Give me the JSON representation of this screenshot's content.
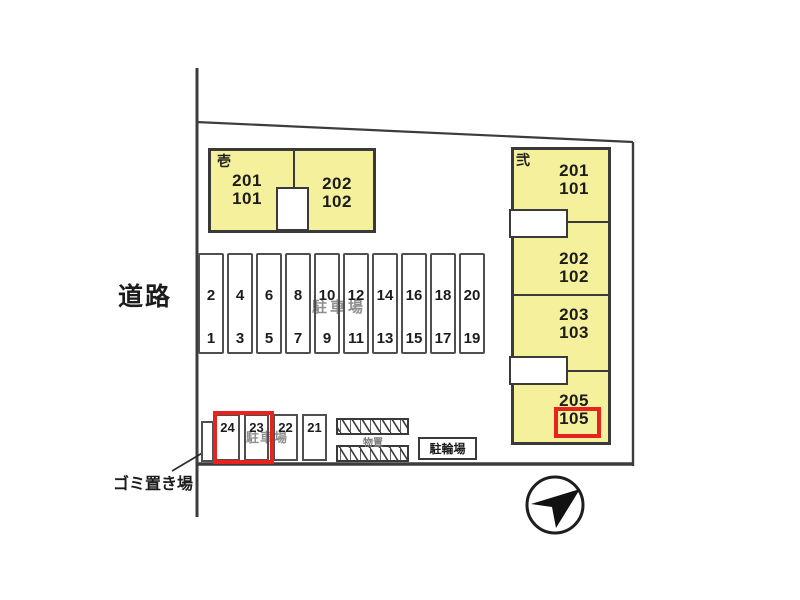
{
  "colors": {
    "building_fill": "#f5f09c",
    "outline": "#3a3a3a",
    "highlight_red": "#e8231d",
    "watermark_gray": "#8f8f8f"
  },
  "labels": {
    "road": "道路",
    "garbage": "ゴミ置き場",
    "storage": "物置",
    "bicycle_parking": "駐輪場"
  },
  "buildings": [
    {
      "name": "壱",
      "units": [
        {
          "upper": "201",
          "lower": "101"
        },
        {
          "upper": "202",
          "lower": "102"
        }
      ]
    },
    {
      "name": "弐",
      "units": [
        {
          "upper": "201",
          "lower": "101"
        },
        {
          "upper": "202",
          "lower": "102"
        },
        {
          "upper": "203",
          "lower": "103"
        },
        {
          "upper": "205",
          "lower": "105"
        }
      ],
      "highlighted_unit": "105"
    }
  ],
  "parking_main": {
    "watermark": "駐車場",
    "stalls": [
      {
        "top": "2",
        "bottom": "1"
      },
      {
        "top": "4",
        "bottom": "3"
      },
      {
        "top": "6",
        "bottom": "5"
      },
      {
        "top": "8",
        "bottom": "7"
      },
      {
        "top": "10",
        "bottom": "9"
      },
      {
        "top": "12",
        "bottom": "11"
      },
      {
        "top": "14",
        "bottom": "13"
      },
      {
        "top": "16",
        "bottom": "15"
      },
      {
        "top": "18",
        "bottom": "17"
      },
      {
        "top": "20",
        "bottom": "19"
      }
    ]
  },
  "parking_lower": {
    "watermark": "駐車場",
    "stalls": [
      "24",
      "23",
      "22",
      "21"
    ],
    "highlighted_stalls": [
      "24",
      "23"
    ]
  },
  "icons": {
    "compass": "north-arrow"
  }
}
